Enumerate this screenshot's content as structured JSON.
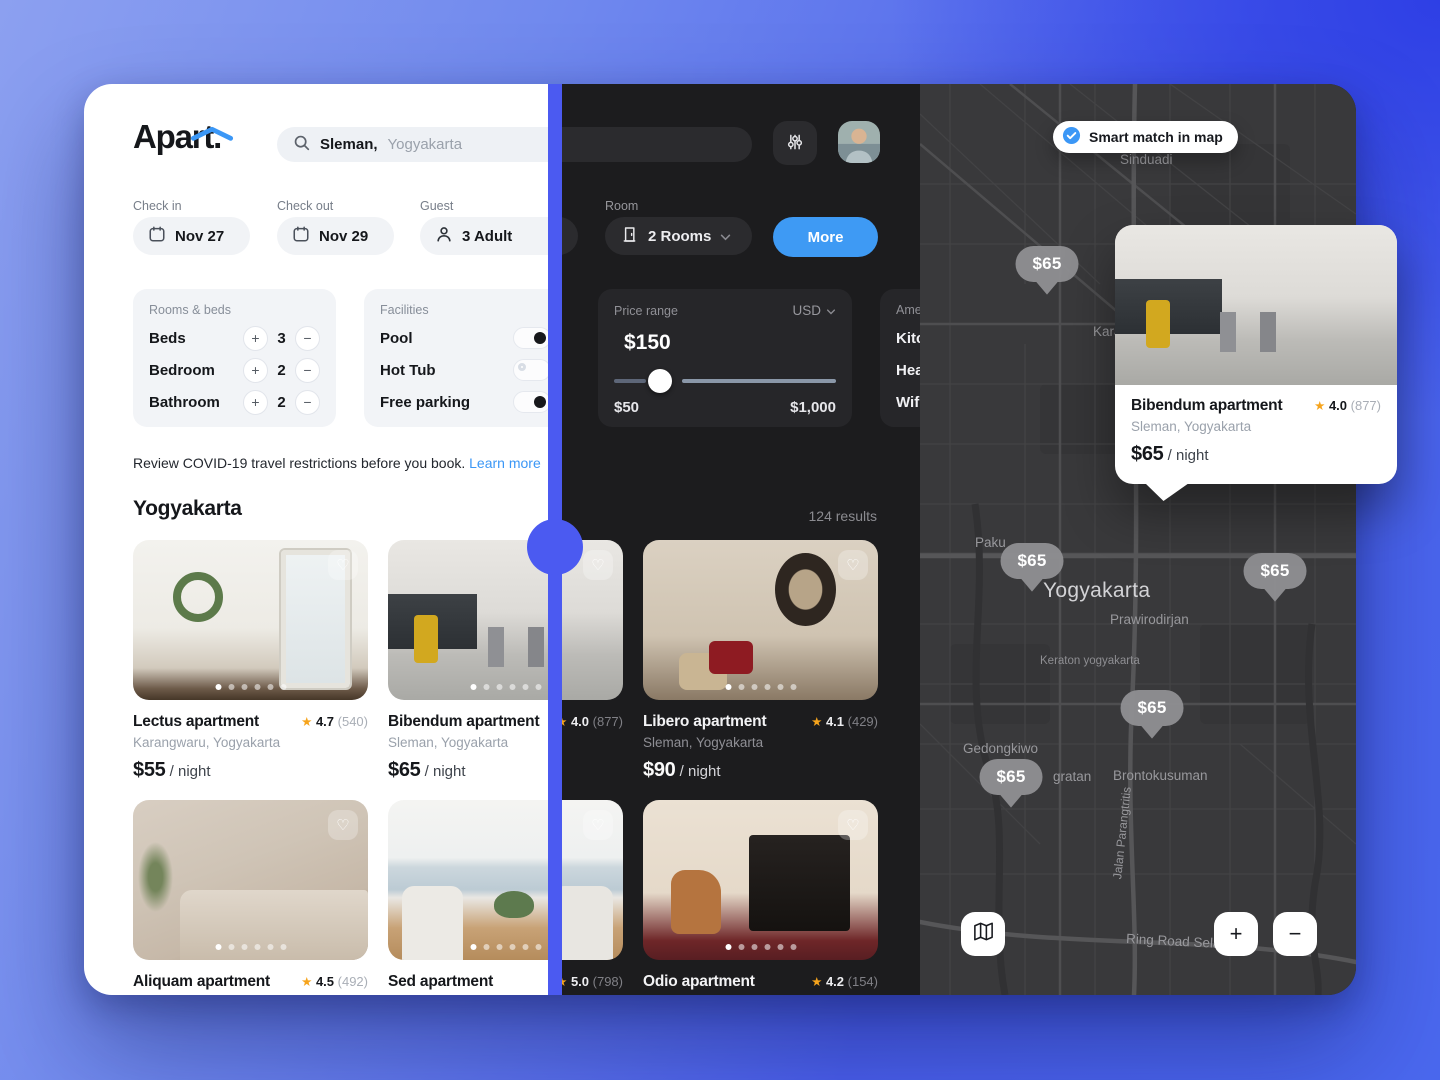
{
  "colors": {
    "accent_blue": "#3b97f6",
    "divider_blue": "#4b5af1",
    "background_blue": "#4a5fec",
    "dark_bg": "#1c1c1e",
    "star_orange": "#f6a41c"
  },
  "icons": {
    "star": "★",
    "heart": "♡",
    "plus": "+",
    "minus": "−",
    "search": "magnifier",
    "calendar": "calendar",
    "person": "person",
    "door": "door",
    "sliders": "filter-sliders",
    "chevron": "chevron-down",
    "check": "check-circle",
    "map_fold": "map"
  },
  "header": {
    "logo": "Apart.",
    "search": {
      "query_bold": "Sleman,",
      "query_rest": "Yogyakarta"
    }
  },
  "filters": {
    "check_in": {
      "label": "Check in",
      "value": "Nov 27"
    },
    "check_out": {
      "label": "Check out",
      "value": "Nov 29"
    },
    "guest": {
      "label": "Guest",
      "value": "3 Adult"
    },
    "room": {
      "label": "Room",
      "value": "2 Rooms"
    },
    "more_button": "More",
    "rooms_beds": {
      "title": "Rooms & beds",
      "rows": [
        {
          "label": "Beds",
          "value": "3"
        },
        {
          "label": "Bedroom",
          "value": "2"
        },
        {
          "label": "Bathroom",
          "value": "2"
        }
      ]
    },
    "facilities": {
      "title": "Facilities",
      "rows": [
        {
          "label": "Pool",
          "state": "on"
        },
        {
          "label": "Hot Tub",
          "state": "off"
        },
        {
          "label": "Free parking",
          "state": "on"
        }
      ]
    },
    "price_range": {
      "title": "Price range",
      "currency": "USD",
      "current": "$150",
      "min": "$50",
      "max": "$1,000"
    },
    "amenities": {
      "title": "Amenities",
      "rows": [
        "Kitchen",
        "Heating",
        "Wifi"
      ]
    }
  },
  "notice": {
    "text": "Review COVID-19 travel restrictions before you book.",
    "link": "Learn more"
  },
  "results": {
    "heading": "Yogyakarta",
    "count": "124 results"
  },
  "listings": [
    {
      "name": "Lectus apartment",
      "location": "Karangwaru, Yogyakarta",
      "price": "$55",
      "unit": "/ night",
      "rating": "4.7",
      "reviews": "(540)"
    },
    {
      "name": "Bibendum apartment",
      "location": "Sleman, Yogyakarta",
      "price": "$65",
      "unit": "/ night",
      "rating": "4.0",
      "reviews": "(877)"
    },
    {
      "name": "Libero apartment",
      "location": "Sleman, Yogyakarta",
      "price": "$90",
      "unit": "/ night",
      "rating": "4.1",
      "reviews": "(429)"
    },
    {
      "name": "Aliquam apartment",
      "rating": "4.5",
      "reviews": "(492)"
    },
    {
      "name": "Sed apartment",
      "rating": "5.0",
      "reviews": "(798)"
    },
    {
      "name": "Odio apartment",
      "rating": "4.2",
      "reviews": "(154)"
    }
  ],
  "map": {
    "smart_match": "Smart match in map",
    "pins": [
      {
        "price": "$65"
      },
      {
        "price": "$65"
      },
      {
        "price": "$65"
      },
      {
        "price": "$65"
      },
      {
        "price": "$65"
      }
    ],
    "labels": {
      "sinduadi": "Sinduadi",
      "karan": "Karan",
      "paku": "Paku",
      "yogyakarta": "Yogyakarta",
      "prawirodirjan": "Prawirodirjan",
      "keraton": "Keraton yogyakarta",
      "gedongkiwo": "Gedongkiwo",
      "gratan": "gratan",
      "brontokusuman": "Brontokusuman",
      "jalan_parangtritis": "Jalan Parangtritis",
      "ring_road": "Ring Road Selatan"
    },
    "popup": {
      "name": "Bibendum apartment",
      "location": "Sleman, Yogyakarta",
      "price": "$65",
      "unit": "/ night",
      "rating": "4.0",
      "reviews": "(877)"
    },
    "controls": {
      "zoom_in": "+",
      "zoom_out": "−"
    }
  }
}
